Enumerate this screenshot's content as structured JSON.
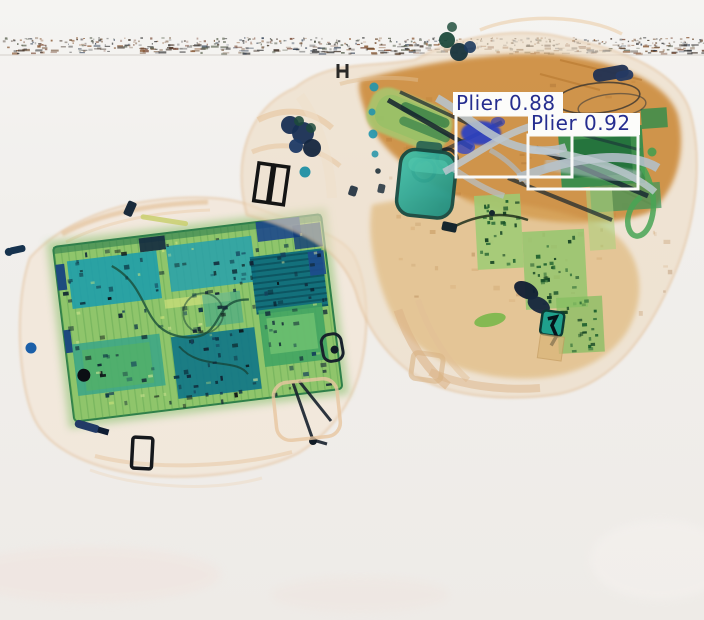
{
  "scene": {
    "type": "x-ray-baggage-scan",
    "background_color": "#f1efec",
    "objects": [
      {
        "name": "scanner-noise-band",
        "tint": "#4a4036"
      },
      {
        "name": "left-bag",
        "description": "soft case containing laptop mainboard",
        "tint": "#e4c19a"
      },
      {
        "name": "laptop-mainboard",
        "tint": "#8fc56b"
      },
      {
        "name": "right-bag",
        "description": "backpack with tools, books, bottle",
        "tint": "#c9832e"
      },
      {
        "name": "bottle",
        "tint": "#2aa893"
      },
      {
        "name": "gray-pliers",
        "tint": "#b7c2ca"
      },
      {
        "name": "scissors",
        "tint": "#16242f"
      }
    ]
  },
  "detections": [
    {
      "label": "Plier",
      "confidence": 0.88,
      "display": "Plier 0.88",
      "box": {
        "x": 456,
        "y": 115,
        "w": 116,
        "h": 62
      },
      "label_box": {
        "x": 453,
        "y": 92,
        "w": 110,
        "h": 23
      },
      "text_pos": {
        "x": 456,
        "y": 110
      }
    },
    {
      "label": "Plier",
      "confidence": 0.92,
      "display": "Plier 0.92",
      "box": {
        "x": 528,
        "y": 135,
        "w": 110,
        "h": 54
      },
      "label_box": {
        "x": 528,
        "y": 113,
        "w": 112,
        "h": 22
      },
      "text_pos": {
        "x": 531,
        "y": 130
      }
    }
  ],
  "overlay": {
    "box_color": "#fafaf8",
    "box_stroke_width": 3,
    "label_bg": "#fcfcfa",
    "label_text_color": "#252d8f",
    "label_font_size": 20
  }
}
